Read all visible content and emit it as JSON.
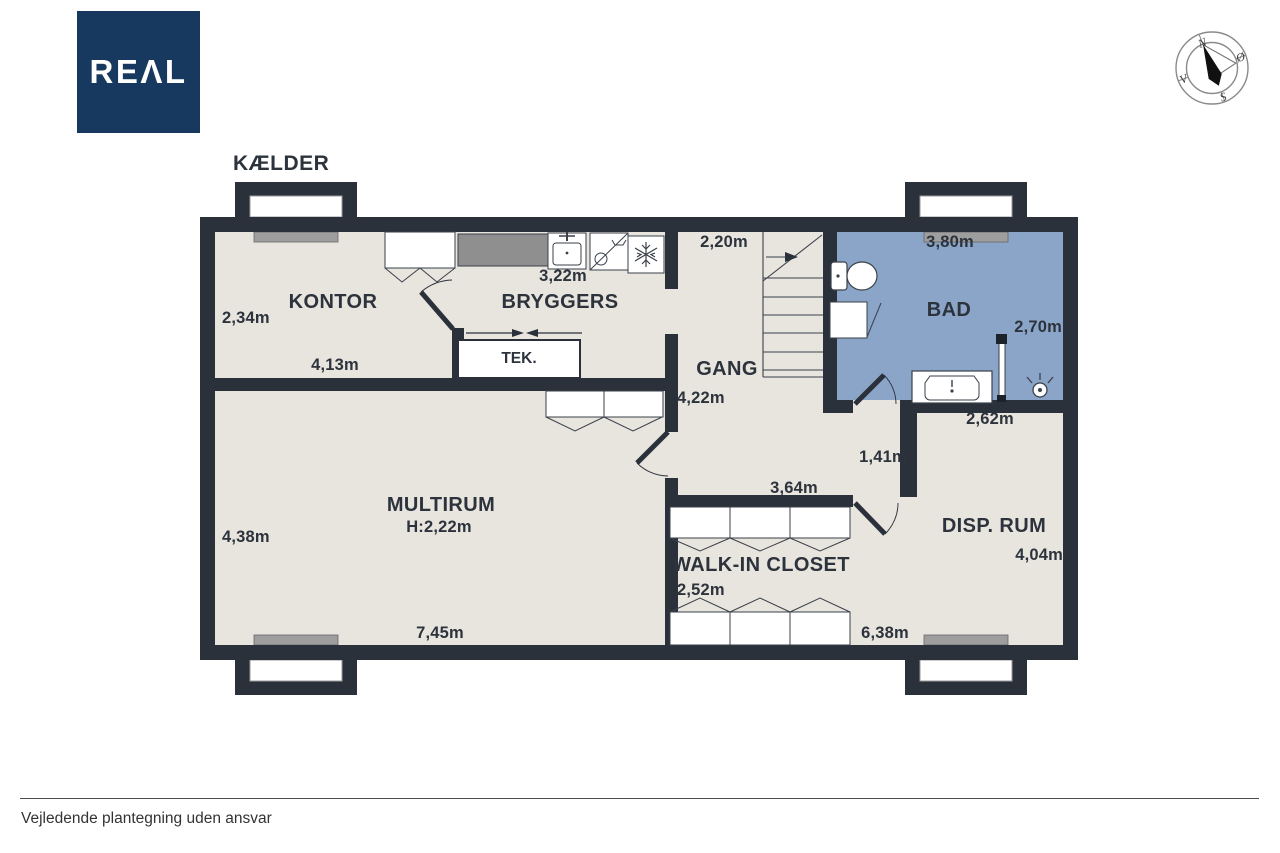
{
  "logo": {
    "text": "REΛL"
  },
  "compass": {
    "north": "N",
    "east": "Ø",
    "south": "S",
    "west": "V"
  },
  "plan": {
    "floor_label": "KÆLDER",
    "rooms": {
      "kontor": {
        "name": "KONTOR",
        "height_label": "2,34m",
        "width_label": "4,13m"
      },
      "bryggers": {
        "name": "BRYGGERS",
        "counter_label": "3,22m"
      },
      "tek": {
        "name": "TEK."
      },
      "gang": {
        "name": "GANG",
        "stair_label": "2,20m",
        "length_label": "4,22m"
      },
      "bad": {
        "name": "BAD",
        "width_label": "3,80m",
        "depth_label": "2,70m"
      },
      "multirum": {
        "name": "MULTIRUM",
        "ceiling_label": "H:2,22m",
        "height_label": "4,38m",
        "width_label": "7,45m"
      },
      "walkin": {
        "name": "WALK-IN CLOSET",
        "top_width_label": "3,64m",
        "depth_label": "2,52m",
        "bottom_width_label": "6,38m"
      },
      "disprum": {
        "name": "DISP. RUM",
        "top_width_label": "2,62m",
        "corridor_label": "1,41m",
        "height_label": "4,04m"
      }
    }
  },
  "footer": {
    "disclaimer": "Vejledende plantegning uden ansvar"
  },
  "colors": {
    "wall": "#2a313a",
    "floor": "#e8e4de",
    "bath": "#8ba5c8",
    "logo_navy": "#17395f",
    "counter_gray": "#8f8f8f"
  }
}
